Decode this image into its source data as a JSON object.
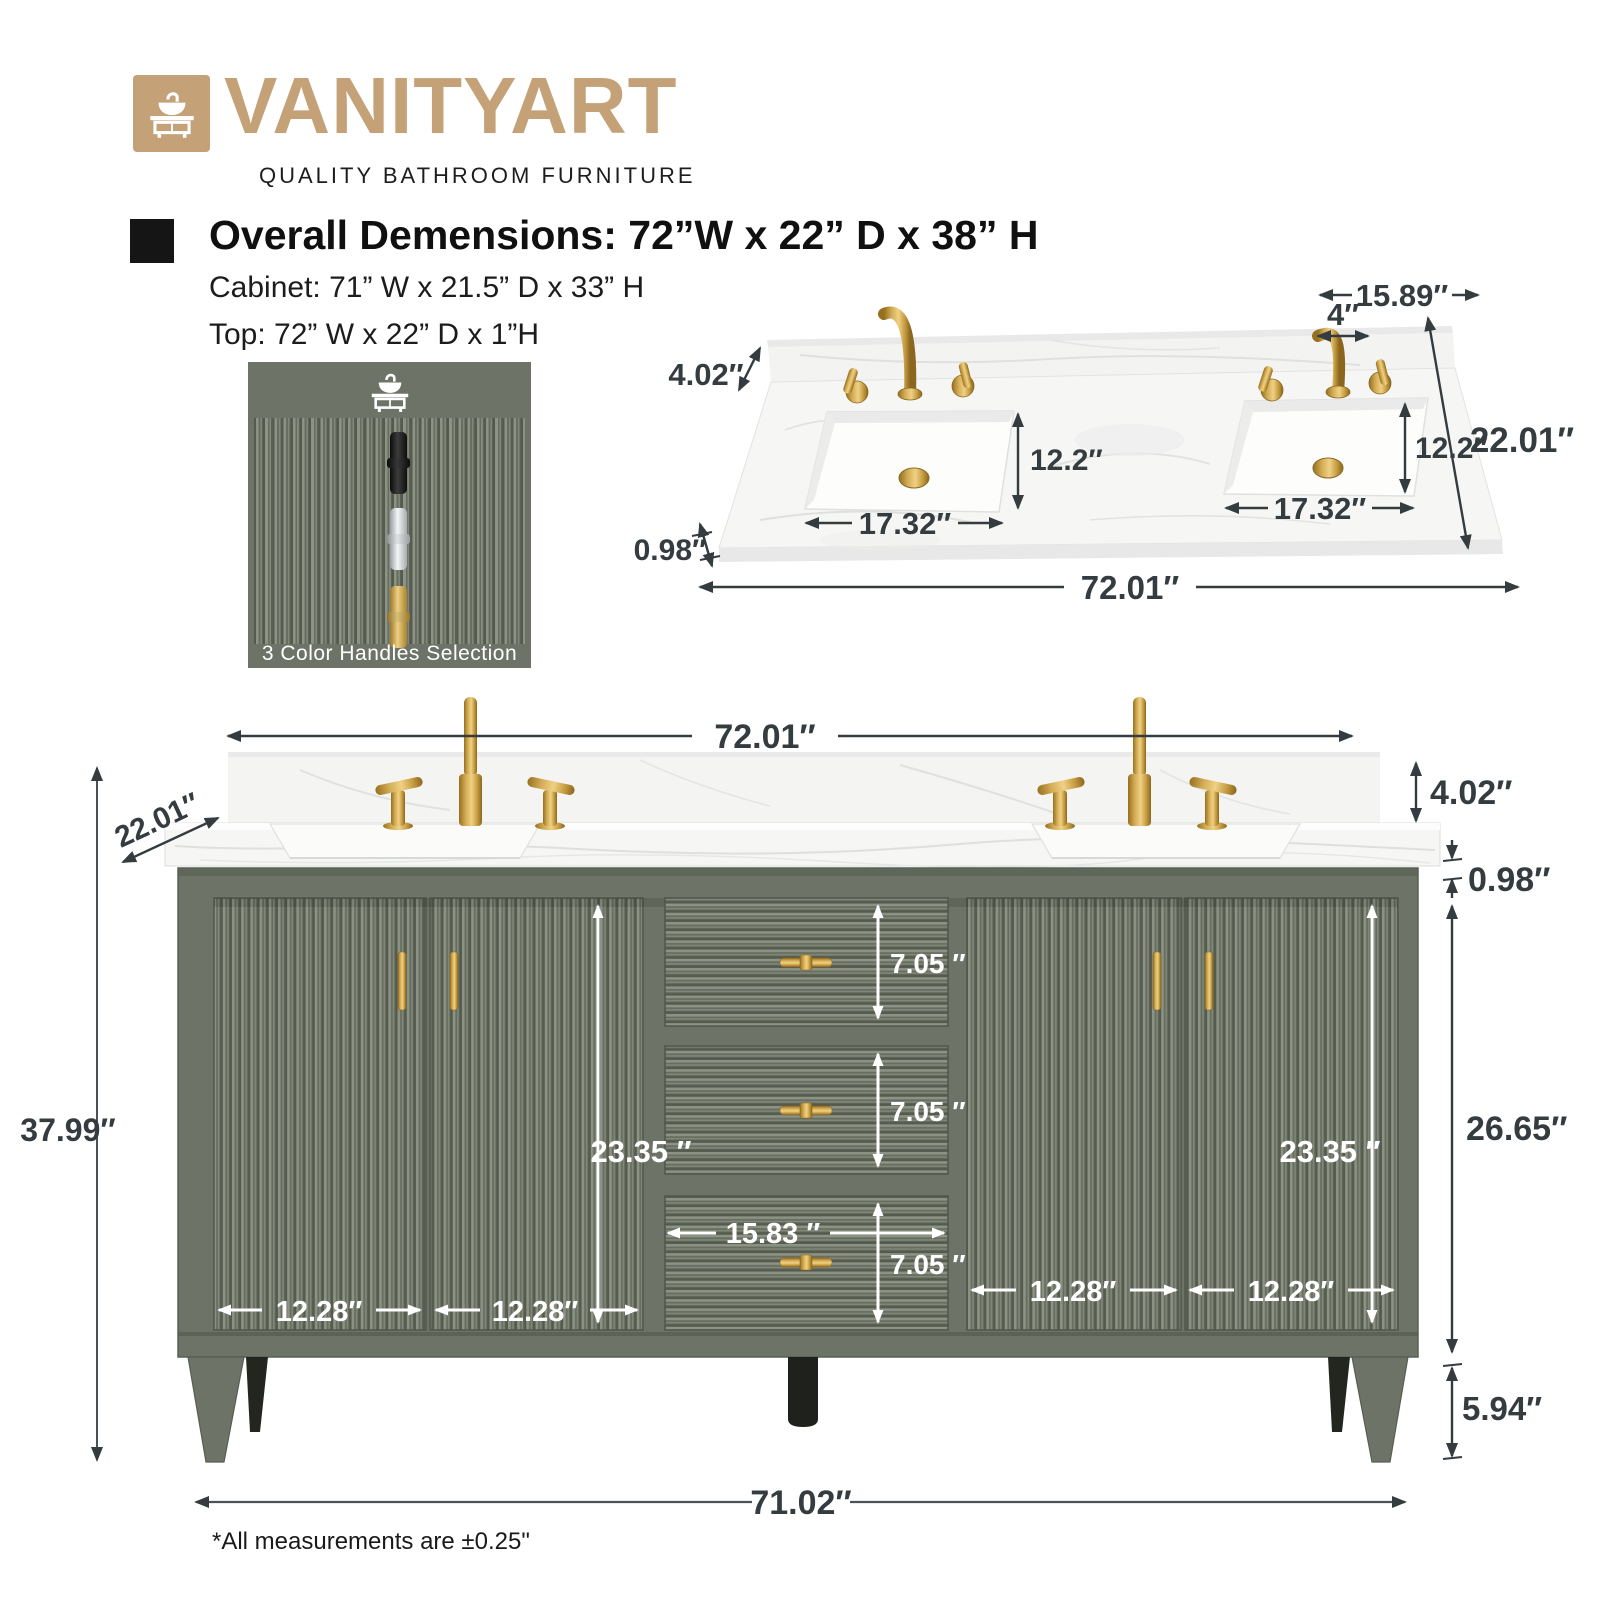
{
  "brand": {
    "name": "VANITYART",
    "tagline": "QUALITY BATHROOM FURNITURE"
  },
  "specs": {
    "overall": "Overall Demensions: 72”W x 22” D x 38” H",
    "cabinet": "Cabinet: 71” W x 21.5” D x 33” H",
    "top": "Top: 72” W x 22” D x 1”H"
  },
  "handles_box": {
    "caption": "3 Color Handles Selection",
    "options": [
      "black",
      "chrome",
      "gold"
    ]
  },
  "dims": {
    "top_view": {
      "back_right_width": "15.89″",
      "faucet_width": "4″",
      "backsplash_height": "4.02″",
      "sink_depth": "12.2″",
      "counter_depth": "22.01″",
      "sink_width": "17.32″",
      "counter_thickness": "0.98″",
      "counter_width": "72.01″"
    },
    "front_view": {
      "counter_width": "72.01″",
      "counter_depth": "22.01″",
      "total_height": "37.99″",
      "backsplash_height": "4.02″",
      "counter_thickness": "0.98″",
      "cabinet_height": "26.65″",
      "door_height": "23.35 ″",
      "door_width": "12.28″",
      "drawer_width": "15.83 ″",
      "drawer_height": "7.05 ″",
      "leg_height": "5.94″",
      "cabinet_width": "71.02″"
    }
  },
  "footnote": "*All measurements are ±0.25\"",
  "colors": {
    "brand_tan": "#c4a176",
    "cabinet_green": "#6d7366",
    "gold": "#c9a44c",
    "dim_dark": "#343c40",
    "marble_white": "#f6f6f5"
  }
}
